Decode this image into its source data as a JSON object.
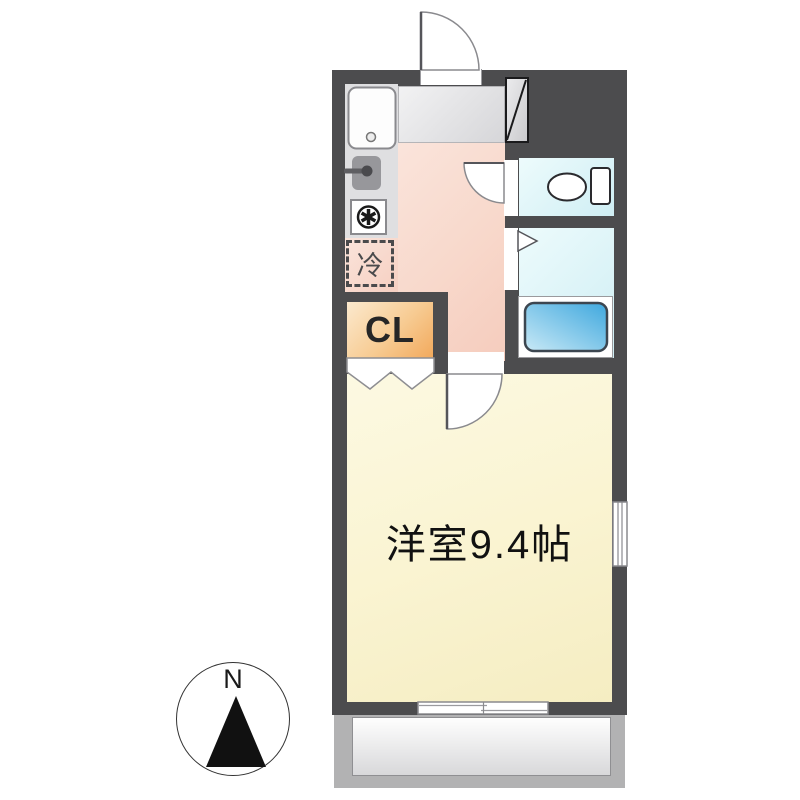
{
  "plan": {
    "labels": {
      "closet": "CL",
      "refrigerator": "冷",
      "main_room": "洋室9.4帖",
      "compass_north": "N"
    }
  },
  "colors": {
    "wall": "#4C4C4E",
    "kitchen_counter": "#DFDFE1",
    "kitchen_floor_light": "#FAE4DB",
    "kitchen_floor_dark": "#F5CCBD",
    "room_floor_light": "#FCF9E2",
    "room_floor_dark": "#F5EDC2",
    "wet_room_light": "#EDFBFC",
    "wet_room_dark": "#CFEEF4",
    "closet_light": "#FBE9CE",
    "closet_dark": "#F2A95C",
    "tub_light": "#C9E9F6",
    "tub_dark": "#3FA8DE",
    "entry_light": "#F2F2F3",
    "entry_dark": "#D6D6D9",
    "balcony_deck": "#B2B2B3",
    "fixture_outline": "#8A8A8E",
    "north_arrow": "#111111"
  }
}
